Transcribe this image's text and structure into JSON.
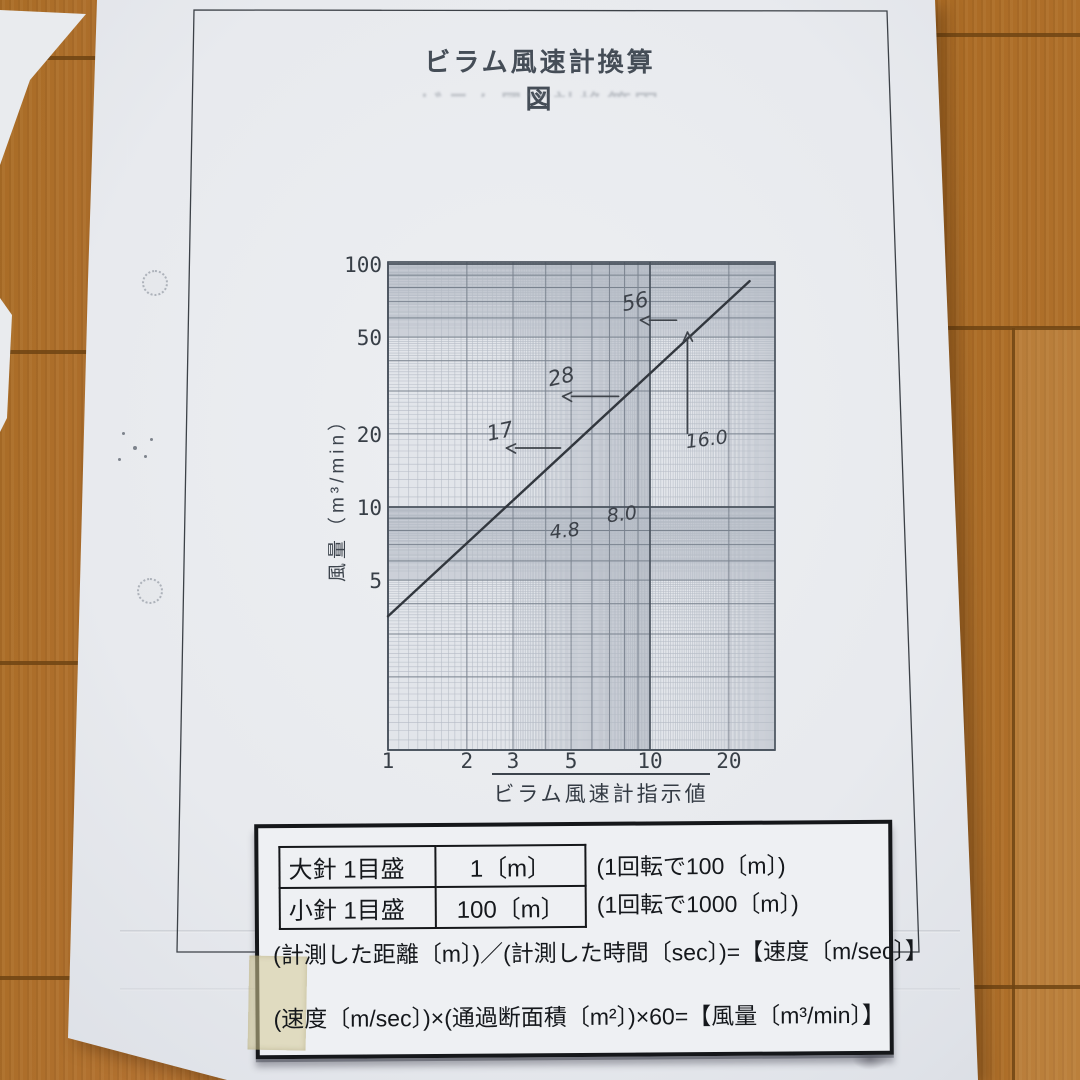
{
  "photo": {
    "scene": "paper document lying on a wooden floor",
    "floor_color": "#ad6d24",
    "paper_color": "#e8eaee"
  },
  "page": {
    "title": "ビラム風速計換算図",
    "note_box": {
      "table": {
        "rows": [
          {
            "label": "大針 1目盛",
            "value": "1〔m〕",
            "note": "(1回転で100〔m〕)"
          },
          {
            "label": "小針 1目盛",
            "value": "100〔m〕",
            "note": "(1回転で1000〔m〕)"
          }
        ]
      },
      "formulas": [
        "(計測した距離〔m〕)／(計測した時間〔sec〕)=【速度〔m/sec〕】",
        "(速度〔m/sec〕)×(通過断面積〔m²〕)×60=【風量〔m³/min〕】"
      ]
    }
  },
  "chart_data": {
    "type": "line",
    "scale": "log-log",
    "title": "ビラム風速計換算図",
    "xlabel": "ビラム風速計指示値",
    "ylabel": "風量（m³/min）",
    "xlim": [
      1,
      30
    ],
    "ylim": [
      1,
      100
    ],
    "x_ticks": [
      1,
      2,
      3,
      5,
      10,
      20
    ],
    "y_ticks": [
      5,
      10,
      20,
      50,
      100
    ],
    "grid": "fine log graph-paper rulings with medium integer lines and heavy decade lines",
    "legend_position": "none",
    "line": {
      "name": "conversion line",
      "relation": "風量 ≈ 3.5 × 指示値",
      "points": [
        [
          1,
          3.55
        ],
        [
          24,
          85
        ]
      ]
    },
    "annotated_points": [
      {
        "x": 4.8,
        "y": 17,
        "x_label": "4.8",
        "y_label": "17"
      },
      {
        "x": 8.0,
        "y": 28,
        "x_label": "8.0",
        "y_label": "28"
      },
      {
        "x": 16.0,
        "y": 56,
        "x_label": "16.0",
        "y_label": "56"
      }
    ]
  }
}
